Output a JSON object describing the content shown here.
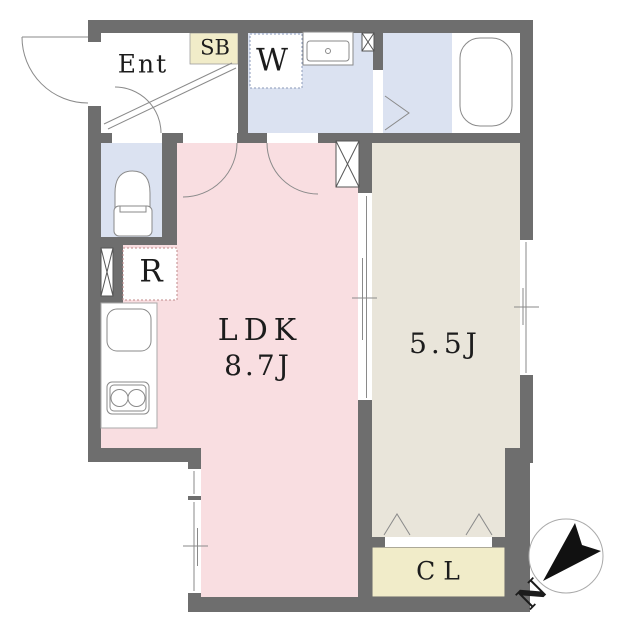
{
  "title": "floor-plan",
  "labels": {
    "entrance": "Ent",
    "shoe_box": "SB",
    "washroom": "W",
    "refrigerator": "R",
    "ldk_name": "LDK",
    "ldk_size": "8.7J",
    "bedroom_size": "5.5J",
    "closet": "CL",
    "compass_north": "N"
  },
  "colors": {
    "wall": "#6e6e6e",
    "ldk_floor": "#f9dee1",
    "wet_floor": "#dbe2f1",
    "bedroom_floor": "#e9e5da",
    "storage": "#f1ecc9",
    "fixture_line": "#8a8a8a",
    "dotted_red": "#c08a8a"
  }
}
